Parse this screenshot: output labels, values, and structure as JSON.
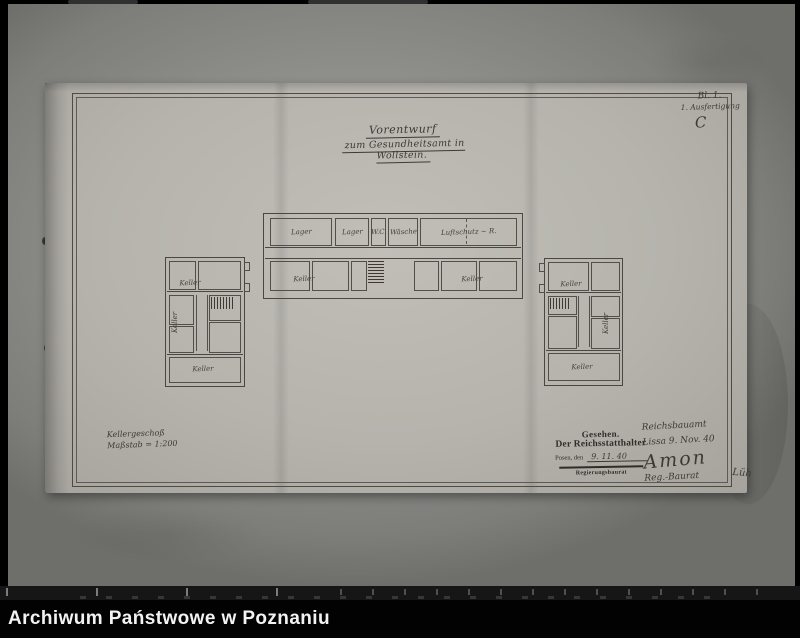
{
  "archive_bar": {
    "label": "Archiwum Państwowe w Poznaniu"
  },
  "title": {
    "line1": "Vorentwurf",
    "line2": "zum Gesundheitsamt in Wollstein."
  },
  "annotations": {
    "sheet_no": "Bl. 1.",
    "copy_note": "1. Ausfertigung",
    "paraph": "C"
  },
  "scale_note": {
    "line1": "Kellergeschoß",
    "line2": "Maßstab = 1:200"
  },
  "stamp": {
    "seen": "Gesehen.",
    "authority": "Der Reichsstatthalter",
    "place_prefix": "Posen, den",
    "date": "9. 11. 40",
    "office": "Regierungsbaurat"
  },
  "note": {
    "office": "Reichsbauamt",
    "place_date": "Lissa 9. Nov. 40",
    "signature": "Amon",
    "title": "Reg.-Baurat",
    "countersign": "Lüh"
  },
  "plans": {
    "center": {
      "top_rooms": [
        "Lager",
        "Lager",
        "W.C.",
        "Wäsche",
        "Luftschutz ~ R."
      ],
      "keller_left": "Keller",
      "keller_right": "Keller"
    },
    "left": {
      "label_top": "Keller",
      "label_side": "Keller",
      "label_bottom": "Keller"
    },
    "right": {
      "label_top": "Keller",
      "label_side": "Keller",
      "label_bottom": "Keller"
    }
  },
  "colors": {
    "ink": "#4a4642",
    "paper": "#b6b3ad",
    "backing": "#90908d",
    "bar_bg": "#020202"
  }
}
